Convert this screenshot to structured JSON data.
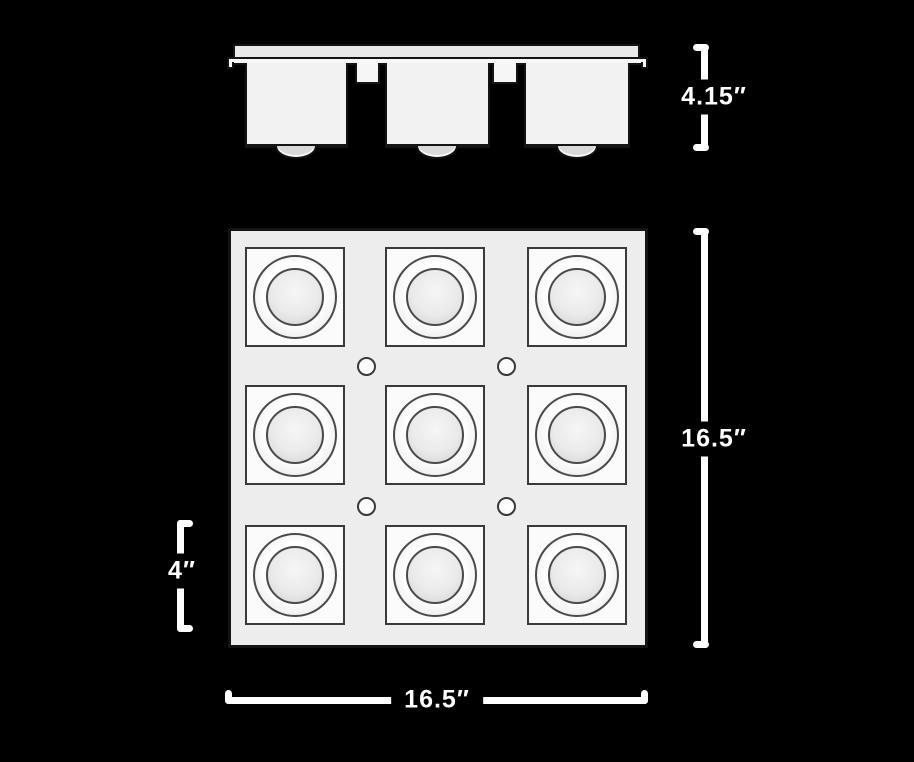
{
  "page": {
    "background_color": "#000000",
    "outline_color": "#141414",
    "fill_color": "#f2f2f2",
    "dimension_color": "#ffffff"
  },
  "side_view": {
    "housings": 3,
    "mounting_tabs": 2,
    "lamp_domes": 3
  },
  "front_view": {
    "grid_rows": 3,
    "grid_cols": 3,
    "light_cells": 9,
    "screw_holes": 4
  },
  "dimensions": {
    "housing_height": "4.15″",
    "fixture_height": "16.5″",
    "fixture_width": "16.5″",
    "cell_size": "4″"
  }
}
